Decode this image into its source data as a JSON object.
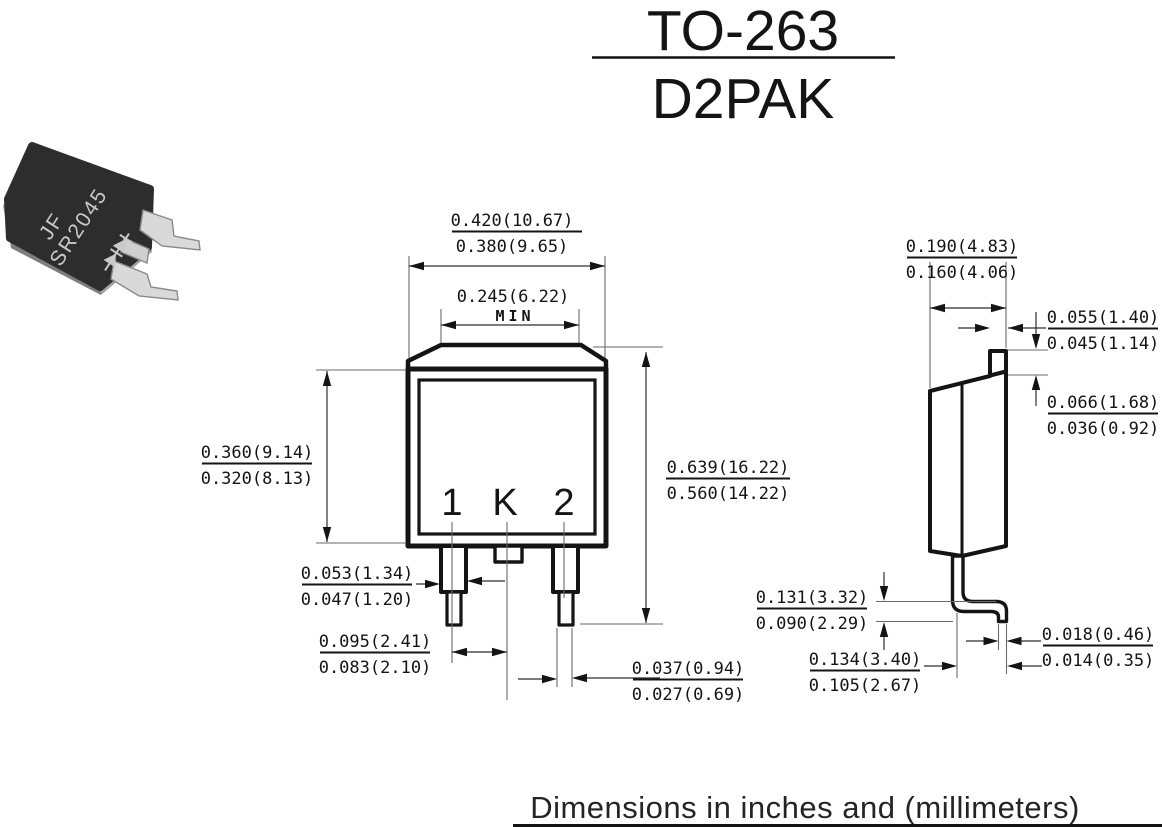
{
  "title": {
    "line1": "TO-263",
    "line2": "D2PAK"
  },
  "footer": {
    "caption": "Dimensions in inches and (millimeters)"
  },
  "photo": {
    "marking_line1": "JF",
    "marking_line2": "SR2045"
  },
  "front_view": {
    "pins": {
      "pin1": "1",
      "pinK": "K",
      "pin2": "2"
    },
    "dims": {
      "overall_width": {
        "max": "0.420(10.67)",
        "min": "0.380(9.65)"
      },
      "tab_width": {
        "value": "0.245(6.22)",
        "note": "MIN"
      },
      "body_height": {
        "max": "0.360(9.14)",
        "min": "0.320(8.13)"
      },
      "overall_height": {
        "max": "0.639(16.22)",
        "min": "0.560(14.22)"
      },
      "lead_width": {
        "max": "0.053(1.34)",
        "min": "0.047(1.20)"
      },
      "lead_pitch": {
        "max": "0.095(2.41)",
        "min": "0.083(2.10)"
      },
      "lead_tip_width": {
        "max": "0.037(0.94)",
        "min": "0.027(0.69)"
      }
    }
  },
  "side_view": {
    "dims": {
      "body_thickness": {
        "max": "0.190(4.83)",
        "min": "0.160(4.06)"
      },
      "tab_thickness": {
        "max": "0.055(1.40)",
        "min": "0.045(1.14)"
      },
      "tab_step_height": {
        "max": "0.066(1.68)",
        "min": "0.036(0.92)"
      },
      "standoff_height": {
        "max": "0.131(3.32)",
        "min": "0.090(2.29)"
      },
      "foot_length": {
        "max": "0.134(3.40)",
        "min": "0.105(2.67)"
      },
      "lead_thickness": {
        "max": "0.018(0.46)",
        "min": "0.014(0.35)"
      }
    }
  },
  "colors": {
    "ink": "#141414",
    "lead_metal": "#d9d9d9",
    "mold_black": "#2d2d2d"
  }
}
